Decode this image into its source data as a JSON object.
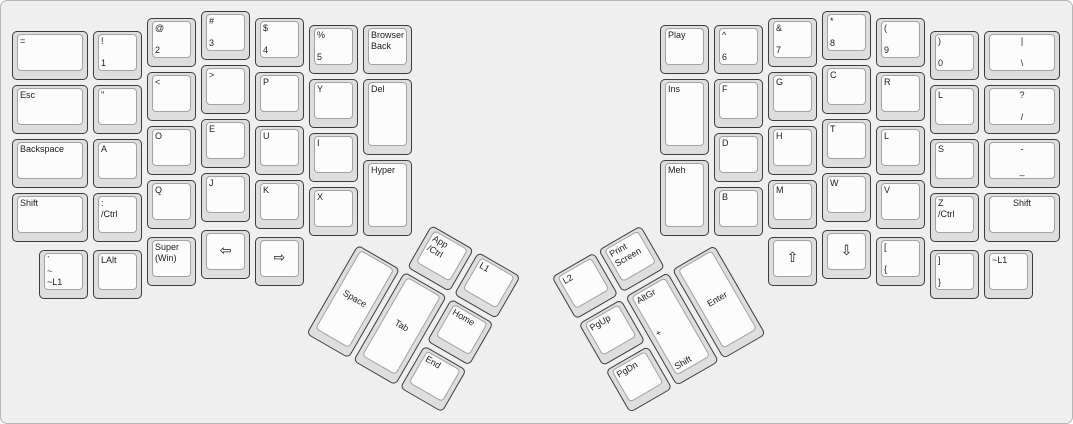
{
  "case": {
    "background": "#efefef",
    "border_color": "#b5b5b5",
    "key_side_color": "#dedede",
    "key_top_color": "#fcfcfc",
    "key_border_color": "#3c3c3c",
    "key_top_border_color": "#a3a3a3",
    "text_color": "#1c1c1c"
  },
  "groups": [
    {
      "name": "left-main",
      "rotate": 0,
      "origin": [
        0,
        0
      ],
      "keys": [
        {
          "id": "equals",
          "x": 11,
          "y": 30,
          "w": 76,
          "h": 49,
          "variant": "tl",
          "labels": [
            "="
          ]
        },
        {
          "id": "1",
          "x": 92,
          "y": 30,
          "w": 49,
          "h": 49,
          "variant": "split",
          "labels": [
            "!",
            "1"
          ]
        },
        {
          "id": "2",
          "x": 146,
          "y": 17,
          "w": 49,
          "h": 49,
          "variant": "split",
          "labels": [
            "@",
            "2"
          ]
        },
        {
          "id": "3",
          "x": 200,
          "y": 10,
          "w": 49,
          "h": 49,
          "variant": "split",
          "labels": [
            "#",
            "3"
          ]
        },
        {
          "id": "4",
          "x": 254,
          "y": 17,
          "w": 49,
          "h": 49,
          "variant": "split",
          "labels": [
            "$",
            "4"
          ]
        },
        {
          "id": "5",
          "x": 308,
          "y": 24,
          "w": 49,
          "h": 49,
          "variant": "split",
          "labels": [
            "%",
            "5"
          ]
        },
        {
          "id": "browser-back",
          "x": 362,
          "y": 24,
          "w": 49,
          "h": 49,
          "variant": "tl",
          "labels": [
            "Browser",
            "Back"
          ]
        },
        {
          "id": "esc",
          "x": 11,
          "y": 84,
          "w": 76,
          "h": 49,
          "variant": "tl",
          "labels": [
            "Esc"
          ]
        },
        {
          "id": "double-quote",
          "x": 92,
          "y": 84,
          "w": 49,
          "h": 49,
          "variant": "tl",
          "labels": [
            "\""
          ]
        },
        {
          "id": "less-than",
          "x": 146,
          "y": 71,
          "w": 49,
          "h": 49,
          "variant": "tl",
          "labels": [
            "<"
          ]
        },
        {
          "id": "greater-than",
          "x": 200,
          "y": 64,
          "w": 49,
          "h": 49,
          "variant": "tl",
          "labels": [
            ">"
          ]
        },
        {
          "id": "p",
          "x": 254,
          "y": 71,
          "w": 49,
          "h": 49,
          "variant": "tl",
          "labels": [
            "P"
          ]
        },
        {
          "id": "y",
          "x": 308,
          "y": 78,
          "w": 49,
          "h": 49,
          "variant": "tl",
          "labels": [
            "Y"
          ]
        },
        {
          "id": "del",
          "x": 362,
          "y": 78,
          "w": 49,
          "h": 76,
          "variant": "tl",
          "labels": [
            "Del"
          ]
        },
        {
          "id": "backspace",
          "x": 11,
          "y": 138,
          "w": 76,
          "h": 49,
          "variant": "tl",
          "labels": [
            "Backspace"
          ]
        },
        {
          "id": "a",
          "x": 92,
          "y": 138,
          "w": 49,
          "h": 49,
          "variant": "tl",
          "labels": [
            "A"
          ]
        },
        {
          "id": "o",
          "x": 146,
          "y": 125,
          "w": 49,
          "h": 49,
          "variant": "tl",
          "labels": [
            "O"
          ]
        },
        {
          "id": "e",
          "x": 200,
          "y": 118,
          "w": 49,
          "h": 49,
          "variant": "tl",
          "labels": [
            "E"
          ]
        },
        {
          "id": "u",
          "x": 254,
          "y": 125,
          "w": 49,
          "h": 49,
          "variant": "tl",
          "labels": [
            "U"
          ]
        },
        {
          "id": "i",
          "x": 308,
          "y": 132,
          "w": 49,
          "h": 49,
          "variant": "tl",
          "labels": [
            "I"
          ]
        },
        {
          "id": "shift-left",
          "x": 11,
          "y": 192,
          "w": 76,
          "h": 49,
          "variant": "tl",
          "labels": [
            "Shift"
          ]
        },
        {
          "id": "colon-ctrl",
          "x": 92,
          "y": 192,
          "w": 49,
          "h": 49,
          "variant": "tl",
          "labels": [
            ":",
            "/Ctrl"
          ]
        },
        {
          "id": "q",
          "x": 146,
          "y": 179,
          "w": 49,
          "h": 49,
          "variant": "tl",
          "labels": [
            "Q"
          ]
        },
        {
          "id": "j",
          "x": 200,
          "y": 172,
          "w": 49,
          "h": 49,
          "variant": "tl",
          "labels": [
            "J"
          ]
        },
        {
          "id": "k",
          "x": 254,
          "y": 179,
          "w": 49,
          "h": 49,
          "variant": "tl",
          "labels": [
            "K"
          ]
        },
        {
          "id": "x",
          "x": 308,
          "y": 186,
          "w": 49,
          "h": 49,
          "variant": "tl",
          "labels": [
            "X"
          ]
        },
        {
          "id": "hyper",
          "x": 362,
          "y": 159,
          "w": 49,
          "h": 76,
          "variant": "tl",
          "labels": [
            "Hyper"
          ]
        },
        {
          "id": "grave-l1",
          "x": 38,
          "y": 249,
          "w": 49,
          "h": 49,
          "variant": "spread",
          "labels": [
            "`",
            "~",
            "~L1"
          ]
        },
        {
          "id": "lalt",
          "x": 92,
          "y": 249,
          "w": 49,
          "h": 49,
          "variant": "tl",
          "labels": [
            "LAlt"
          ]
        },
        {
          "id": "super-win",
          "x": 146,
          "y": 236,
          "w": 49,
          "h": 49,
          "variant": "tl",
          "labels": [
            "Super",
            "(Win)"
          ]
        },
        {
          "id": "arrow-left",
          "x": 200,
          "y": 229,
          "w": 49,
          "h": 49,
          "variant": "arrow",
          "labels": [
            "⇦"
          ]
        },
        {
          "id": "arrow-right",
          "x": 254,
          "y": 236,
          "w": 49,
          "h": 49,
          "variant": "arrow",
          "labels": [
            "⇨"
          ]
        }
      ]
    },
    {
      "name": "left-thumb",
      "rotate": 30,
      "origin": [
        356,
        241
      ],
      "keys": [
        {
          "id": "app-ctrl",
          "x": 56,
          "y": -52,
          "w": 49,
          "h": 49,
          "variant": "tl",
          "labels": [
            "App",
            "/Ctrl"
          ]
        },
        {
          "id": "l1",
          "x": 110,
          "y": -52,
          "w": 49,
          "h": 49,
          "variant": "tl",
          "labels": [
            "L1"
          ]
        },
        {
          "id": "space",
          "x": 2,
          "y": 2,
          "w": 49,
          "h": 103,
          "variant": "center",
          "labels": [
            "Space"
          ]
        },
        {
          "id": "tab",
          "x": 56,
          "y": 2,
          "w": 49,
          "h": 103,
          "variant": "center",
          "labels": [
            "Tab"
          ]
        },
        {
          "id": "home",
          "x": 110,
          "y": 2,
          "w": 49,
          "h": 49,
          "variant": "tl",
          "labels": [
            "Home"
          ]
        },
        {
          "id": "end",
          "x": 110,
          "y": 56,
          "w": 49,
          "h": 49,
          "variant": "tl",
          "labels": [
            "End"
          ]
        }
      ]
    },
    {
      "name": "right-main",
      "rotate": 0,
      "origin": [
        0,
        0
      ],
      "keys": [
        {
          "id": "play",
          "x": 659,
          "y": 24,
          "w": 49,
          "h": 49,
          "variant": "tl",
          "labels": [
            "Play"
          ]
        },
        {
          "id": "6",
          "x": 713,
          "y": 24,
          "w": 49,
          "h": 49,
          "variant": "split",
          "labels": [
            "^",
            "6"
          ]
        },
        {
          "id": "7",
          "x": 767,
          "y": 17,
          "w": 49,
          "h": 49,
          "variant": "split",
          "labels": [
            "&",
            "7"
          ]
        },
        {
          "id": "8",
          "x": 821,
          "y": 10,
          "w": 49,
          "h": 49,
          "variant": "split",
          "labels": [
            "*",
            "8"
          ]
        },
        {
          "id": "9",
          "x": 875,
          "y": 17,
          "w": 49,
          "h": 49,
          "variant": "split",
          "labels": [
            "(",
            "9"
          ]
        },
        {
          "id": "0",
          "x": 929,
          "y": 30,
          "w": 49,
          "h": 49,
          "variant": "split",
          "labels": [
            ")",
            "0"
          ]
        },
        {
          "id": "pipe-backslash",
          "x": 983,
          "y": 30,
          "w": 76,
          "h": 49,
          "variant": "splitc",
          "labels": [
            "|",
            "\\"
          ]
        },
        {
          "id": "ins",
          "x": 659,
          "y": 78,
          "w": 49,
          "h": 76,
          "variant": "tl",
          "labels": [
            "Ins"
          ]
        },
        {
          "id": "f",
          "x": 713,
          "y": 78,
          "w": 49,
          "h": 49,
          "variant": "tl",
          "labels": [
            "F"
          ]
        },
        {
          "id": "g",
          "x": 767,
          "y": 71,
          "w": 49,
          "h": 49,
          "variant": "tl",
          "labels": [
            "G"
          ]
        },
        {
          "id": "c",
          "x": 821,
          "y": 64,
          "w": 49,
          "h": 49,
          "variant": "tl",
          "labels": [
            "C"
          ]
        },
        {
          "id": "r",
          "x": 875,
          "y": 71,
          "w": 49,
          "h": 49,
          "variant": "tl",
          "labels": [
            "R"
          ]
        },
        {
          "id": "l-top",
          "x": 929,
          "y": 84,
          "w": 49,
          "h": 49,
          "variant": "tl",
          "labels": [
            "L"
          ]
        },
        {
          "id": "question-slash",
          "x": 983,
          "y": 84,
          "w": 76,
          "h": 49,
          "variant": "splitc",
          "labels": [
            "?",
            "/"
          ]
        },
        {
          "id": "meh",
          "x": 659,
          "y": 159,
          "w": 49,
          "h": 76,
          "variant": "tl",
          "labels": [
            "Meh"
          ]
        },
        {
          "id": "d",
          "x": 713,
          "y": 132,
          "w": 49,
          "h": 49,
          "variant": "tl",
          "labels": [
            "D"
          ]
        },
        {
          "id": "h",
          "x": 767,
          "y": 125,
          "w": 49,
          "h": 49,
          "variant": "tl",
          "labels": [
            "H"
          ]
        },
        {
          "id": "t",
          "x": 821,
          "y": 118,
          "w": 49,
          "h": 49,
          "variant": "tl",
          "labels": [
            "T"
          ]
        },
        {
          "id": "l-home",
          "x": 875,
          "y": 125,
          "w": 49,
          "h": 49,
          "variant": "tl",
          "labels": [
            "L"
          ]
        },
        {
          "id": "s",
          "x": 929,
          "y": 138,
          "w": 49,
          "h": 49,
          "variant": "tl",
          "labels": [
            "S"
          ]
        },
        {
          "id": "minus-underscore",
          "x": 983,
          "y": 138,
          "w": 76,
          "h": 49,
          "variant": "splitc",
          "labels": [
            "-",
            "_"
          ]
        },
        {
          "id": "b",
          "x": 713,
          "y": 186,
          "w": 49,
          "h": 49,
          "variant": "tl",
          "labels": [
            "B"
          ]
        },
        {
          "id": "m",
          "x": 767,
          "y": 179,
          "w": 49,
          "h": 49,
          "variant": "tl",
          "labels": [
            "M"
          ]
        },
        {
          "id": "w",
          "x": 821,
          "y": 172,
          "w": 49,
          "h": 49,
          "variant": "tl",
          "labels": [
            "W"
          ]
        },
        {
          "id": "v",
          "x": 875,
          "y": 179,
          "w": 49,
          "h": 49,
          "variant": "tl",
          "labels": [
            "V"
          ]
        },
        {
          "id": "z-ctrl",
          "x": 929,
          "y": 192,
          "w": 49,
          "h": 49,
          "variant": "tl",
          "labels": [
            "Z",
            "/Ctrl"
          ]
        },
        {
          "id": "shift-right",
          "x": 983,
          "y": 192,
          "w": 76,
          "h": 49,
          "variant": "tc",
          "labels": [
            "Shift"
          ]
        },
        {
          "id": "arrow-up",
          "x": 767,
          "y": 236,
          "w": 49,
          "h": 49,
          "variant": "arrow",
          "labels": [
            "⇧"
          ]
        },
        {
          "id": "arrow-down",
          "x": 821,
          "y": 229,
          "w": 49,
          "h": 49,
          "variant": "arrow",
          "labels": [
            "⇩"
          ]
        },
        {
          "id": "lbracket",
          "x": 875,
          "y": 236,
          "w": 49,
          "h": 49,
          "variant": "split",
          "labels": [
            "[",
            "{"
          ]
        },
        {
          "id": "rbracket",
          "x": 929,
          "y": 249,
          "w": 49,
          "h": 49,
          "variant": "split",
          "labels": [
            "]",
            "}"
          ]
        },
        {
          "id": "tilde-l1",
          "x": 983,
          "y": 249,
          "w": 49,
          "h": 49,
          "variant": "tl",
          "labels": [
            "~L1"
          ]
        }
      ]
    },
    {
      "name": "right-thumb",
      "rotate": -30,
      "origin": [
        715,
        241
      ],
      "keys": [
        {
          "id": "l2",
          "x": -160,
          "y": -52,
          "w": 49,
          "h": 49,
          "variant": "tl",
          "labels": [
            "L2"
          ]
        },
        {
          "id": "print-screen",
          "x": -106,
          "y": -52,
          "w": 49,
          "h": 49,
          "variant": "tl",
          "labels": [
            "Print",
            "Screen"
          ]
        },
        {
          "id": "pgup",
          "x": -160,
          "y": 2,
          "w": 49,
          "h": 49,
          "variant": "tl",
          "labels": [
            "PgUp"
          ]
        },
        {
          "id": "pgdn",
          "x": -160,
          "y": 56,
          "w": 49,
          "h": 49,
          "variant": "tl",
          "labels": [
            "PgDn"
          ]
        },
        {
          "id": "altgr-shift",
          "x": -106,
          "y": 2,
          "w": 49,
          "h": 103,
          "variant": "spread",
          "labels": [
            "AltGr",
            "+",
            "Shift"
          ]
        },
        {
          "id": "enter",
          "x": -52,
          "y": 2,
          "w": 49,
          "h": 103,
          "variant": "center",
          "labels": [
            "Enter"
          ]
        }
      ]
    }
  ]
}
